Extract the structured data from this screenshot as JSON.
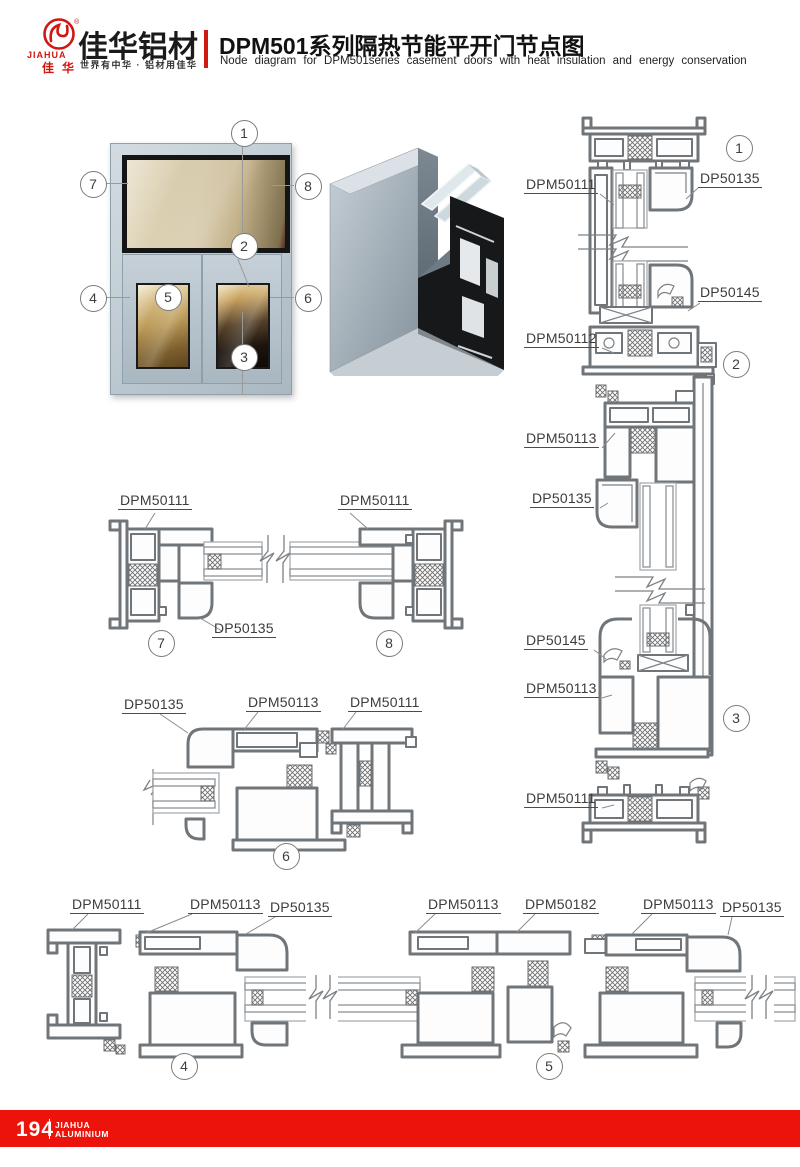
{
  "header": {
    "logo": {
      "brand_en": "JIAHUA",
      "brand_cn": "佳华",
      "reg_mark": "®"
    },
    "company_name": "佳华铝材",
    "slogan": "世界有中华 · 铝材用佳华",
    "title_cn": "DPM501系列隔热节能平开门节点图",
    "title_en": "Node diagram for DPM501series casement doors with heat insulation and energy conservation"
  },
  "overview": {
    "callouts": [
      "1",
      "2",
      "3",
      "4",
      "5",
      "6",
      "7",
      "8"
    ]
  },
  "sections": {
    "vertical": {
      "labels": [
        "DPM50111",
        "DP50135",
        "DP50145",
        "DPM50112",
        "DPM50113",
        "DP50135",
        "DP50145",
        "DPM50113",
        "DPM50111"
      ],
      "callouts": [
        "1",
        "2",
        "3"
      ]
    },
    "top_horizontal": {
      "labels": [
        "DPM50111",
        "DPM50111",
        "DP50135"
      ],
      "callouts": [
        "7",
        "8"
      ]
    },
    "mullion": {
      "labels": [
        "DP50135",
        "DPM50113",
        "DPM50111"
      ],
      "callouts": [
        "6"
      ]
    },
    "bottom_horizontal": {
      "labels": [
        "DPM50111",
        "DPM50113",
        "DP50135",
        "DPM50113",
        "DPM50182",
        "DPM50113",
        "DP50135"
      ],
      "callouts": [
        "4",
        "5"
      ]
    }
  },
  "footer": {
    "page_number": "194",
    "brand_line1": "JIAHUA",
    "brand_line2": "ALUMINIUM"
  },
  "colors": {
    "brand_red": "#d01712",
    "footer_red": "#ec130b",
    "drawing_line": "#70757a"
  }
}
